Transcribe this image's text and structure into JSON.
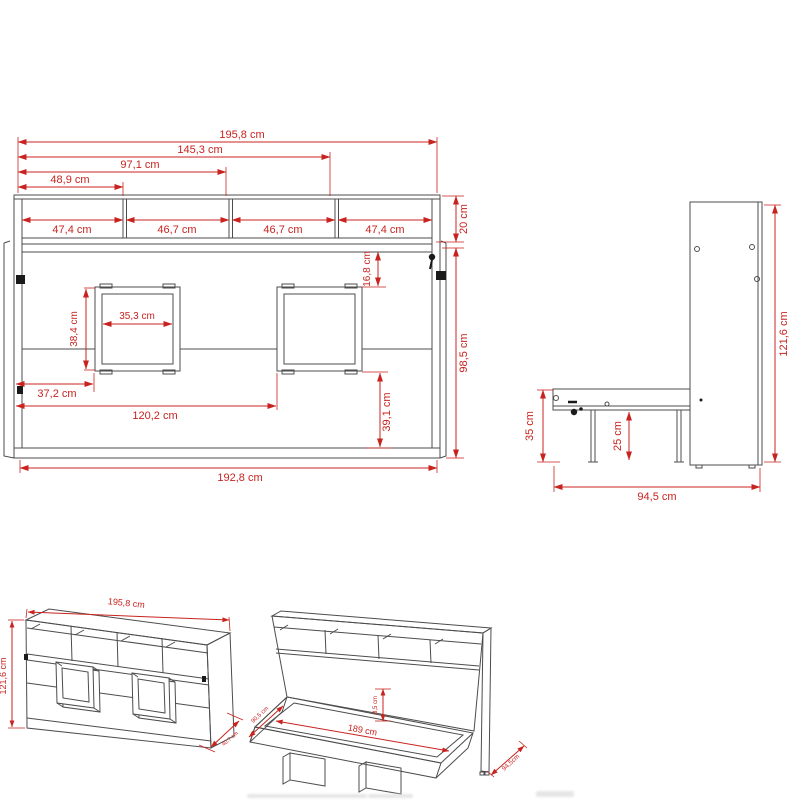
{
  "title": "wall bed with shelves - dimensional technical drawing",
  "colors": {
    "background": "#ffffff",
    "line": "#4c4c4c",
    "dimension": "#c8231f"
  },
  "front": {
    "d195": "195,8 cm",
    "d1453": "145,3 cm",
    "d971": "97,1 cm",
    "d489": "48,9 cm",
    "s1": "47,4 cm",
    "s2": "46,7 cm",
    "s3": "46,7 cm",
    "s4": "47,4 cm",
    "d20": "20 cm",
    "d168": "16,8 cm",
    "d384": "38,4 cm",
    "d353": "35,3 cm",
    "d372": "37,2 cm",
    "d1202": "120,2 cm",
    "d391": "39,1 cm",
    "d985": "98,5 cm",
    "d1928": "192,8 cm"
  },
  "side": {
    "d1216": "121,6 cm",
    "d35": "35 cm",
    "d25": "25 cm",
    "d945": "94,5 cm"
  },
  "closed": {
    "d1958": "195,8 cm",
    "d1216": "121,6 cm",
    "ddepth": "40,7 cm"
  },
  "open": {
    "d189": "189 cm",
    "d85": "8,5 cm",
    "d905": "90,5 cm",
    "d945": "94,5cm"
  }
}
